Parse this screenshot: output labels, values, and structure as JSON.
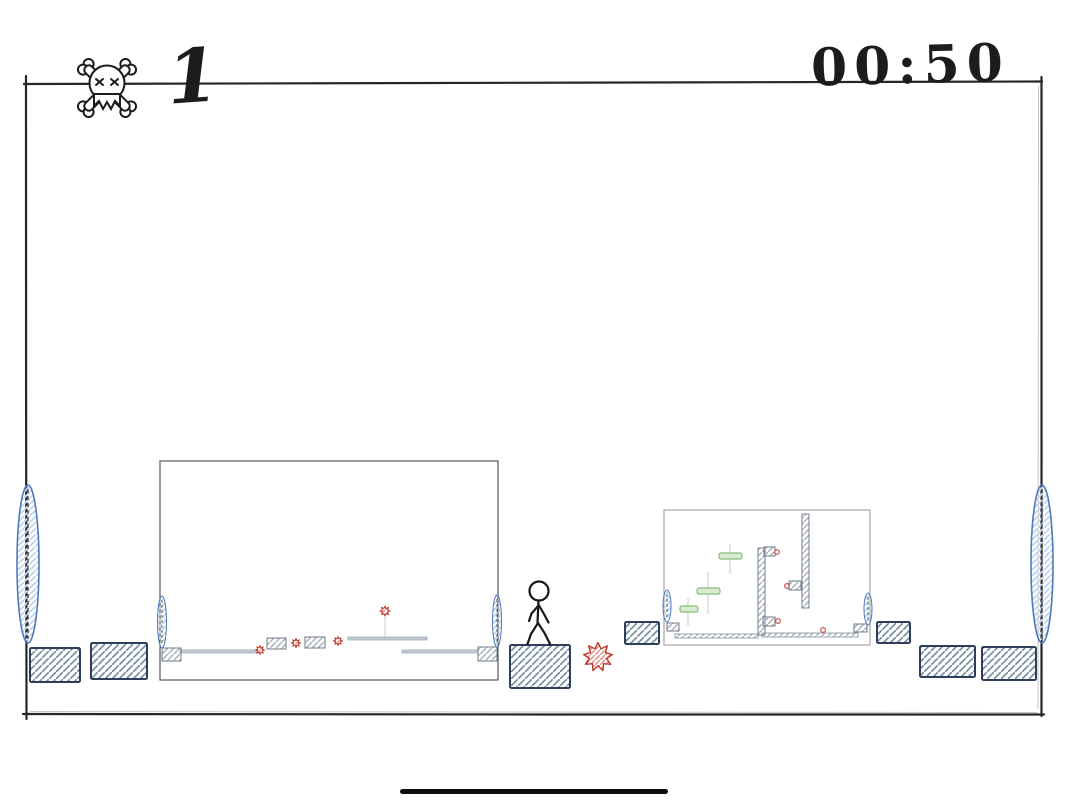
{
  "hud": {
    "deaths_icon": "skull-crossbones-icon",
    "deaths": "1",
    "timer": "00:50"
  },
  "colors": {
    "ink": "#262626",
    "block_border": "#2c3e59",
    "block_hatch": "#7b8fa8",
    "portal_stroke": "#4f79bd",
    "portal_hatch": "#c4d7ee",
    "spike_red": "#c0392b",
    "spike_hatch": "#e59087",
    "green_platform": "#8abb76",
    "green_fill": "#d9ecd2",
    "preview1_border": "#4b4b4b",
    "preview2_border": "#a0a0a0",
    "bottom_bar": "#0d0d0d"
  },
  "level": {
    "world_border": {
      "x": 26,
      "y": 82,
      "w": 1016,
      "h": 632
    },
    "player": {
      "type": "stick-figure",
      "x": 539,
      "y": 612
    },
    "portals": [
      {
        "side": "left",
        "cx": 28,
        "cy": 564,
        "rx": 11,
        "ry": 79
      },
      {
        "side": "right",
        "cx": 1042,
        "cy": 564,
        "rx": 11,
        "ry": 79
      }
    ],
    "blocks": [
      [
        30,
        648,
        50,
        34
      ],
      [
        91,
        643,
        56,
        36
      ],
      [
        510,
        645,
        60,
        43
      ],
      [
        625,
        622,
        34,
        22
      ],
      [
        877,
        622,
        33,
        21
      ],
      [
        920,
        646,
        55,
        31
      ],
      [
        982,
        647,
        54,
        33
      ]
    ],
    "spikes": [
      {
        "cx": 598,
        "cy": 657,
        "r": 14.5
      }
    ],
    "previews": [
      {
        "frame": [
          160,
          461,
          338,
          219
        ],
        "border": "#4b4b4b",
        "portals": [
          {
            "cx": 162,
            "cy": 622,
            "rx": 4.5,
            "ry": 26
          },
          {
            "cx": 497,
            "cy": 621,
            "rx": 4.5,
            "ry": 26
          }
        ],
        "gray_blocks": [
          [
            162,
            648,
            19,
            13
          ],
          [
            267,
            638,
            19,
            11
          ],
          [
            305,
            637,
            20,
            11
          ],
          [
            478,
            647,
            19,
            14
          ]
        ],
        "thin_platforms": [
          [
            180,
            650,
            77,
            3
          ],
          [
            348,
            637,
            79,
            3
          ],
          [
            402,
            650,
            76,
            3
          ]
        ],
        "tracks": [
          [
            385,
            616,
            385,
            637
          ]
        ],
        "spikes": [
          {
            "cx": 260,
            "cy": 650,
            "r": 4.5
          },
          {
            "cx": 296,
            "cy": 643,
            "r": 4.5
          },
          {
            "cx": 338,
            "cy": 641,
            "r": 4.5
          },
          {
            "cx": 385,
            "cy": 611,
            "r": 5
          }
        ],
        "walls": [],
        "floors": [],
        "greens": [],
        "dots": []
      },
      {
        "frame": [
          664,
          510,
          206,
          135
        ],
        "border": "#a0a0a0",
        "portals": [
          {
            "cx": 667,
            "cy": 606,
            "rx": 4,
            "ry": 16
          },
          {
            "cx": 868,
            "cy": 609,
            "rx": 4,
            "ry": 16
          }
        ],
        "gray_blocks": [
          [
            667,
            623,
            12,
            8
          ],
          [
            764,
            547,
            11,
            9
          ],
          [
            789,
            581,
            12,
            9
          ],
          [
            763,
            617,
            12,
            9
          ],
          [
            854,
            624,
            13,
            8
          ]
        ],
        "walls": [
          [
            758,
            548,
            7,
            87
          ],
          [
            802,
            514,
            7,
            94
          ]
        ],
        "floors": [
          [
            675,
            634,
            83,
            4
          ],
          [
            762,
            633,
            96,
            4
          ]
        ],
        "greens": [
          {
            "x": 680,
            "y": 606,
            "w": 18,
            "h": 6,
            "track": [
              688,
              598,
              688,
              626
            ]
          },
          {
            "x": 697,
            "y": 588,
            "w": 23,
            "h": 6,
            "track": [
              708,
              572,
              708,
              614
            ]
          },
          {
            "x": 719,
            "y": 553,
            "w": 23,
            "h": 6,
            "track": [
              730,
              544,
              730,
              574
            ]
          }
        ],
        "dots": [
          [
            777,
            552
          ],
          [
            787,
            586
          ],
          [
            778,
            621
          ],
          [
            823,
            630
          ]
        ],
        "thin_platforms": [],
        "tracks": [],
        "spikes": []
      }
    ]
  }
}
